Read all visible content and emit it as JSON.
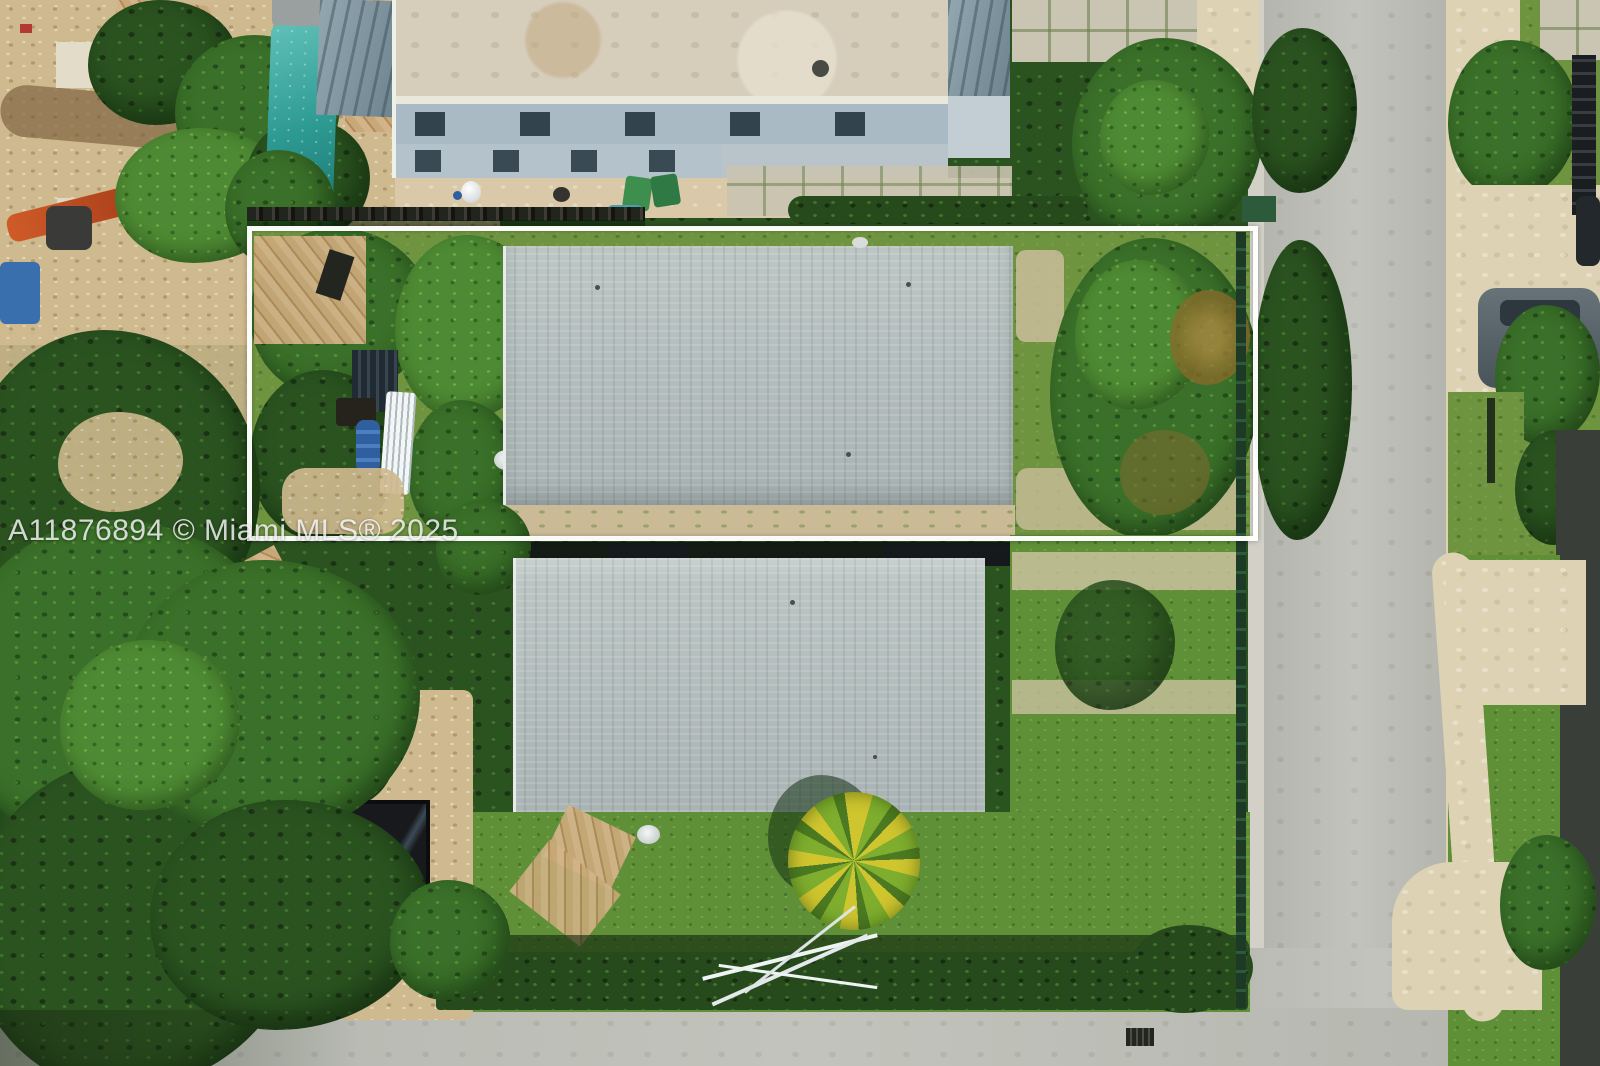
{
  "watermark": {
    "text": "A11876894 © Miami MLS® 2025"
  },
  "scene": {
    "kind": "aerial-drone-photo",
    "subject": "residential corner lot with white property-boundary outline around upper parcel, two gray-shingle-roof houses, neighboring modern building with pool, construction site, streets and dense tropical vegetation",
    "overlay": {
      "boundary_color": "#ffffff"
    },
    "colors": {
      "vegetation_dark": "#2b5320",
      "vegetation_mid": "#3a7029",
      "vegetation_bright": "#4e8a33",
      "lawn": "#5f9038",
      "lot_grass": "#6f9440",
      "roof_shingle": "#b5bfbe",
      "flat_roof": "#d6cdbb",
      "modern_building": "#9fb2bd",
      "pool_teal": "#2e9b93",
      "street": "#bdbfb7",
      "concrete_walk": "#ddd3b4",
      "construction_sand": "#cfb98e",
      "hedge": "#274a1c",
      "container_orange": "#d98b2d",
      "barrel_blue": "#2f5f9e",
      "pvc_pipe_white": "#e8eef0",
      "excavator_orange": "#cf5b28"
    }
  }
}
